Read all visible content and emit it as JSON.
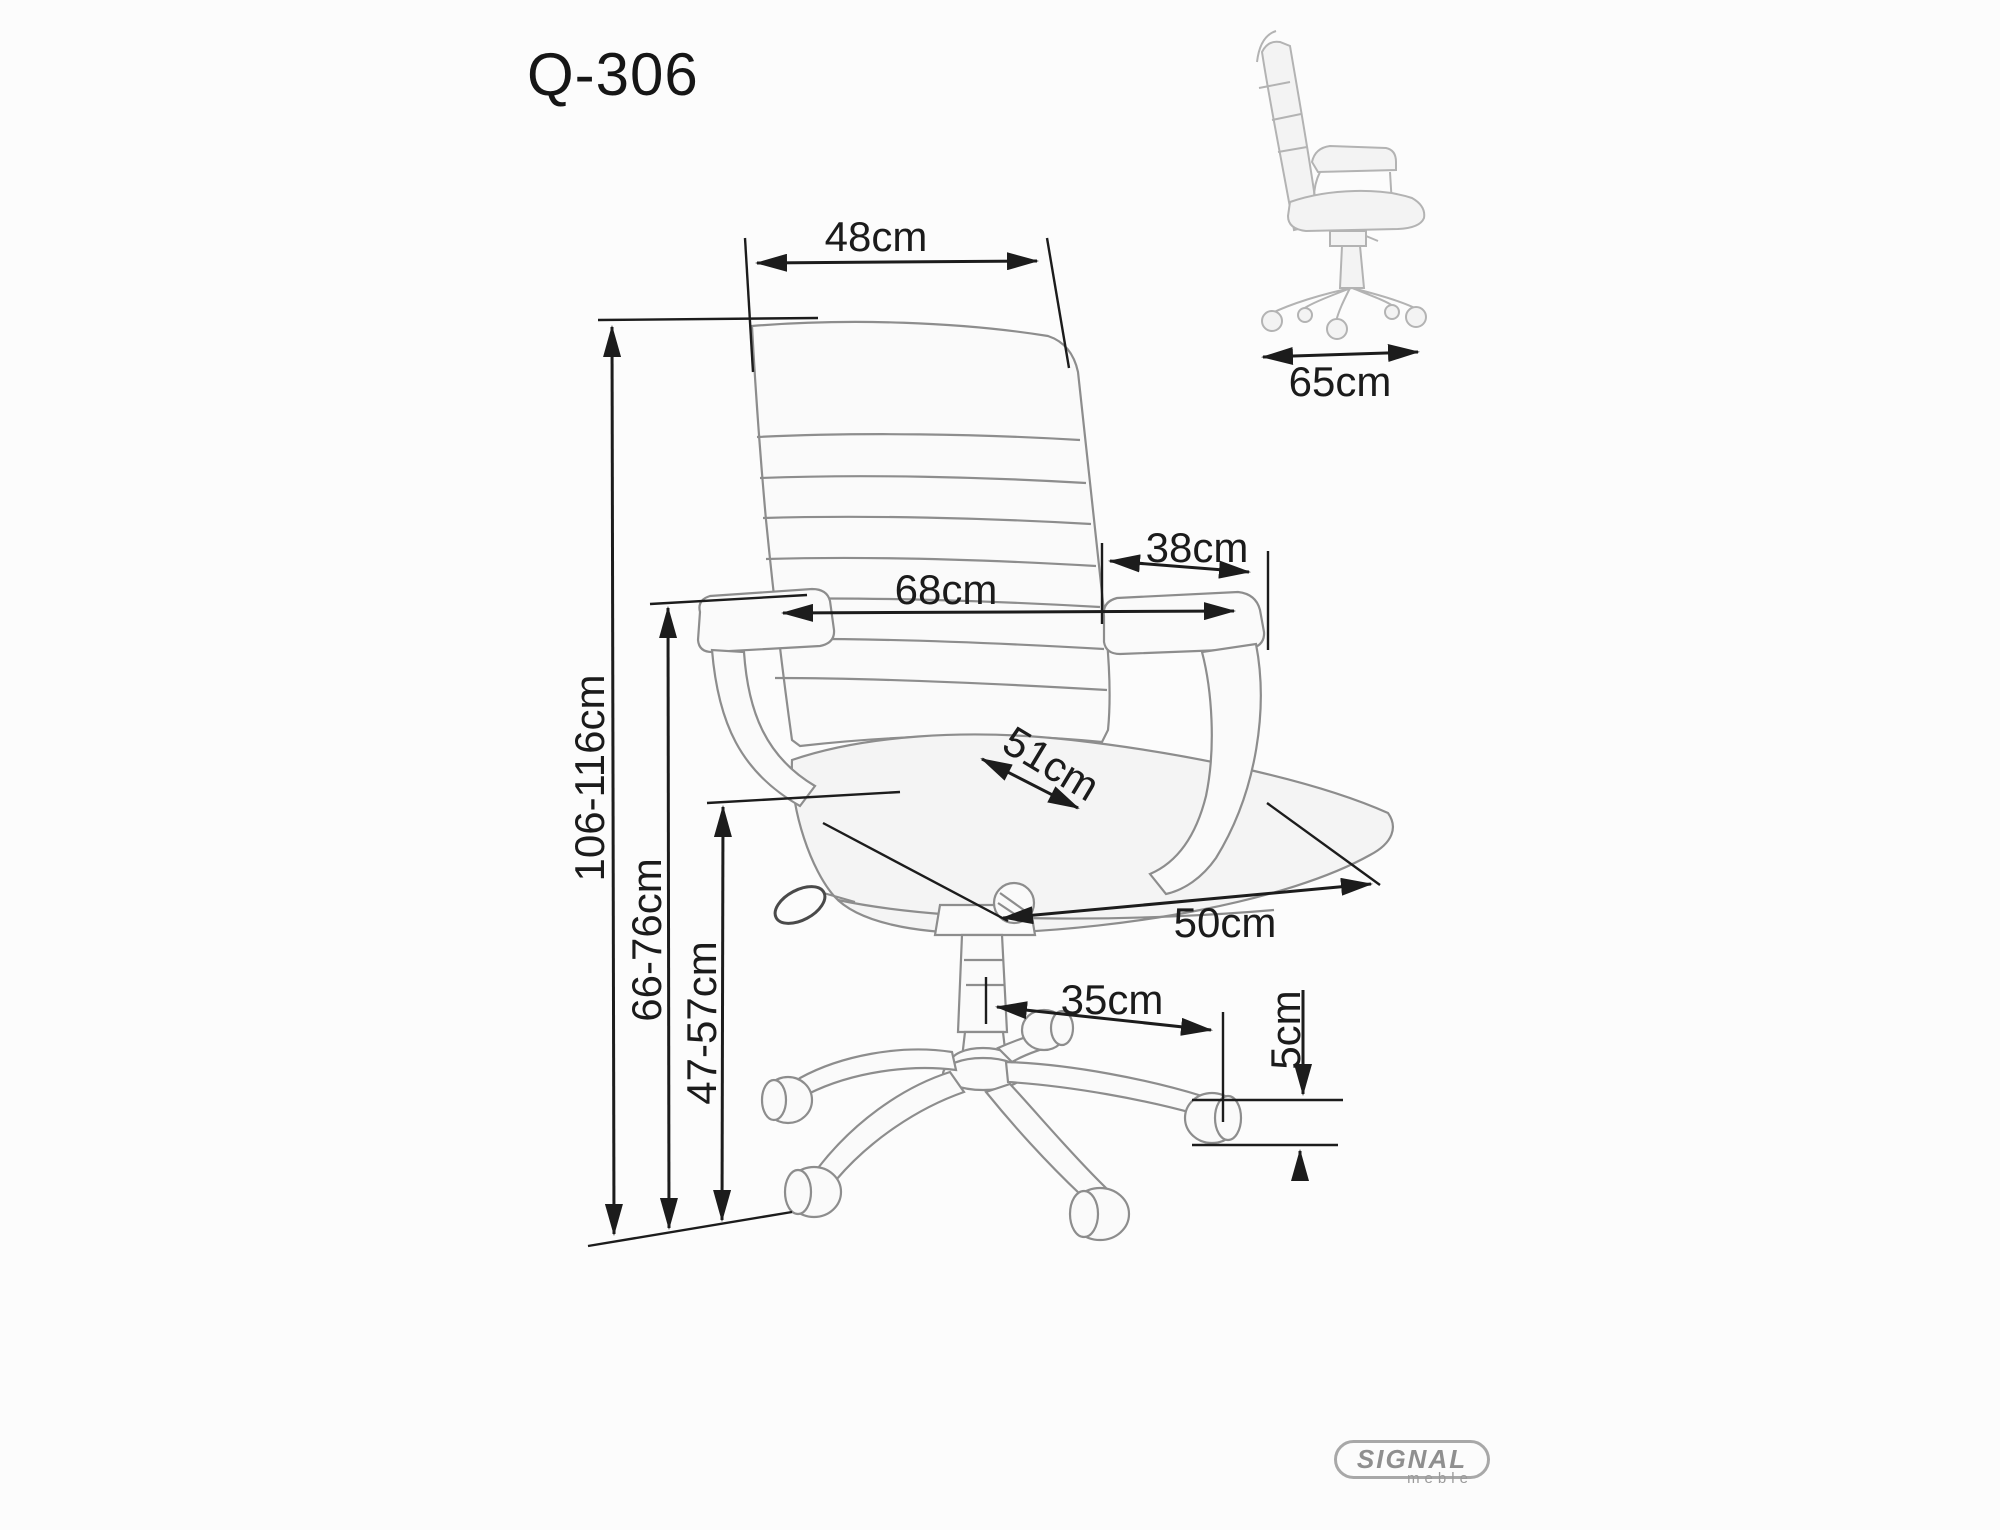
{
  "title": "Q-306",
  "dimensions": {
    "backrest_width": "48cm",
    "armrest_length": "38cm",
    "overall_width": "68cm",
    "seat_width": "51cm",
    "seat_depth": "50cm",
    "base_arm_span": "35cm",
    "caster_height": "5cm",
    "overall_height": "106-116cm",
    "armrest_height": "66-76cm",
    "seat_height": "47-57cm",
    "overall_depth": "65cm"
  },
  "logo": {
    "brand": "SIGNAL",
    "subtitle": "meble"
  },
  "colors": {
    "dimension_ink": "#1c1c1c",
    "sketch_line": "#8d8d8d",
    "side_view_line": "#b3b3b3",
    "logo_gray": "#8f8f8f",
    "background": "#fcfcfc"
  }
}
